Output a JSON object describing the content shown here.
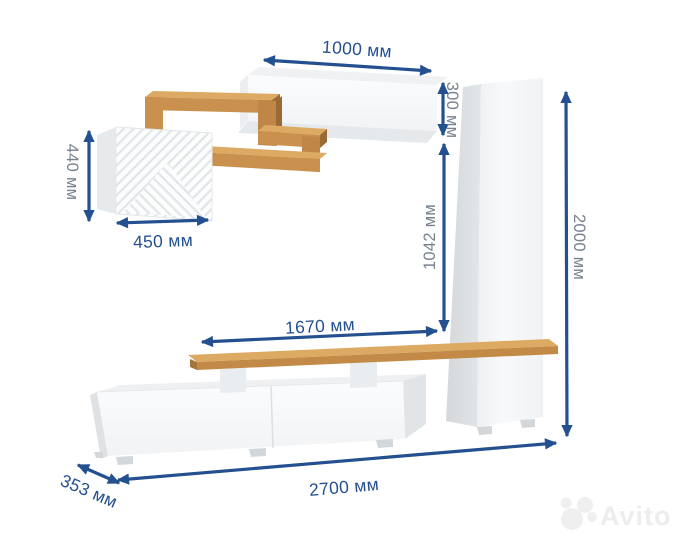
{
  "diagram": {
    "type": "furniture dimension diagram",
    "subject": "living-room wall unit (TV stand, tall cabinet, hanging cabinets, zigzag shelf)",
    "unit": "мм",
    "dim": {
      "d1000": {
        "label": "1000 мм",
        "mm": 1000,
        "role": "hanging cabinet width"
      },
      "d300": {
        "label": "300 мм",
        "mm": 300,
        "role": "hanging cabinet height"
      },
      "d440": {
        "label": "440 мм",
        "mm": 440,
        "role": "square cabinet height"
      },
      "d450": {
        "label": "450 мм",
        "mm": 450,
        "role": "square cabinet width"
      },
      "d1042": {
        "label": "1042 мм",
        "mm": 1042,
        "role": "shelf to hanging cabinet gap"
      },
      "d2000": {
        "label": "2000 мм",
        "mm": 2000,
        "role": "total height"
      },
      "d1670": {
        "label": "1670 мм",
        "mm": 1670,
        "role": "tv shelf length"
      },
      "d2700": {
        "label": "2700 мм",
        "mm": 2700,
        "role": "total width"
      },
      "d353": {
        "label": "353 мм",
        "mm": 353,
        "role": "depth"
      }
    },
    "colors": {
      "dimension_line": "#24508f",
      "vertical_label": "#78828e",
      "oak_front": "#c9914d",
      "oak_top": "#dcaa62",
      "white_front": "#fafbfc",
      "side_gray": "#e3e6e9"
    },
    "watermark": {
      "brand": "Avito"
    }
  }
}
